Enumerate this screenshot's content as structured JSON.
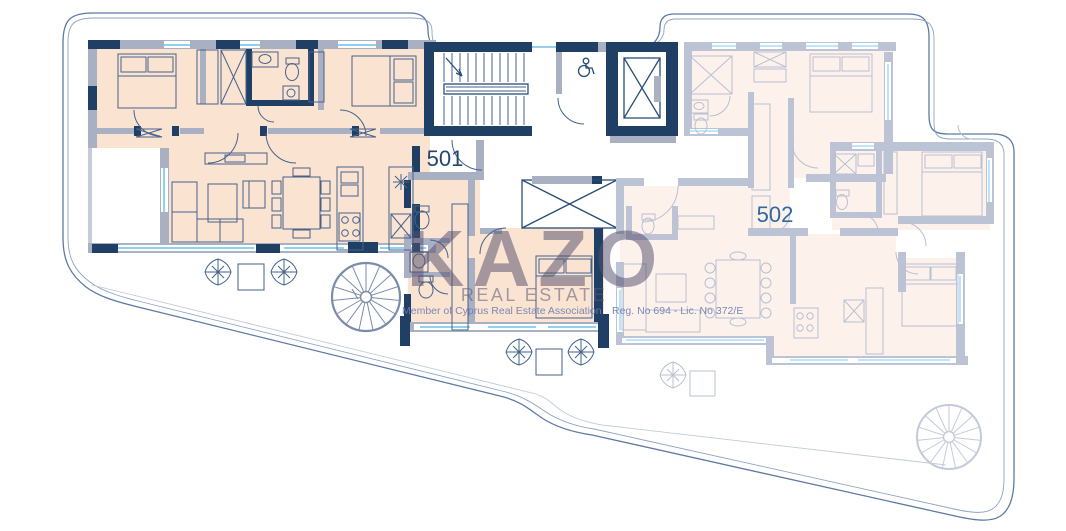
{
  "floor_plan": {
    "units": [
      {
        "id": "unit-501",
        "label": "501",
        "highlighted": true
      },
      {
        "id": "unit-502",
        "label": "502",
        "highlighted": false
      }
    ],
    "watermark": {
      "brand": "KAZO",
      "tagline": "REAL ESTATE",
      "membership": "Member of Cyprus Real Estate Association",
      "license": "Reg. No 694 - Lic. No 372/E"
    },
    "colors": {
      "unit501_wall": "#1f4064",
      "unit501_fill": "#fae3d1",
      "unit502_wall": "#bcc3d4",
      "unit502_fill": "#fdf1ec",
      "window_glass": "#8ed2f0",
      "boundary_line": "#5d7aa5",
      "label_501": "#26456f",
      "label_502": "#2f69a4",
      "watermark": "#55516e"
    }
  }
}
